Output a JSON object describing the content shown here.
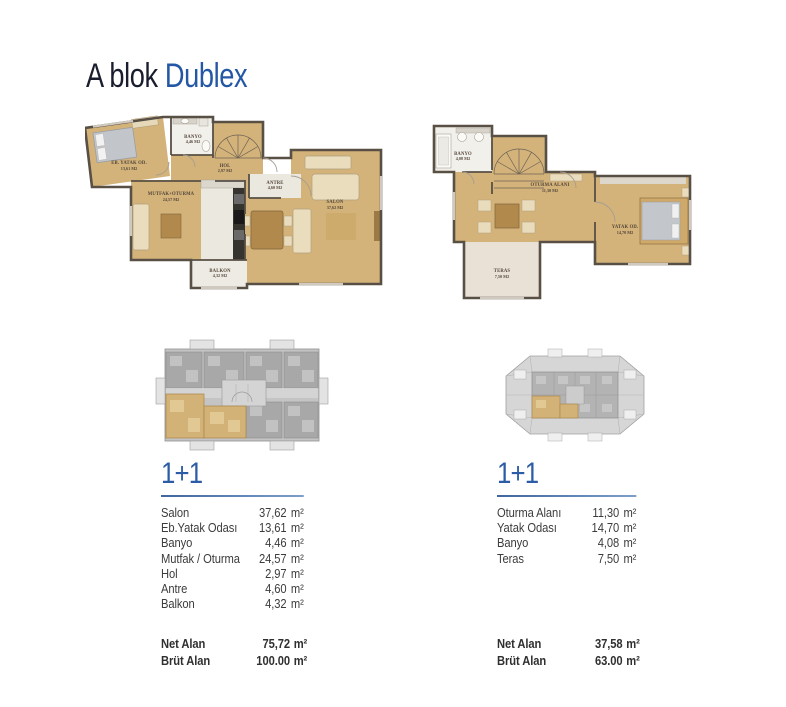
{
  "page": {
    "title_prefix": "A blok",
    "title_highlight": "Dublex"
  },
  "colors": {
    "accent_blue": "#2d5ca6",
    "title_dark": "#1a1d2e",
    "plan_room_tan": "#d3b37a",
    "plan_wall": "#584f45",
    "highlight_unit_tan": "#d2b277"
  },
  "left_unit": {
    "plan_type": "1+1",
    "plan": {
      "bedroom": {
        "name": "EB. YATAK OD.",
        "area": "13,61 M2"
      },
      "banyo": {
        "name": "BANYO",
        "area": "4,46 M2"
      },
      "hol": {
        "name": "HOL",
        "area": "2,97 M2"
      },
      "antre": {
        "name": "ANTRE",
        "area": "4,60 M2"
      },
      "salon": {
        "name": "SALON",
        "area": "37,62 M2"
      },
      "mutfak": {
        "name": "MUTFAK+OTURMA",
        "area": "24,57 M2"
      },
      "balkon": {
        "name": "BALKON",
        "area": "4,32 M2"
      }
    },
    "table": {
      "rows": [
        {
          "label": "Salon",
          "value": "37,62",
          "unit": "m²"
        },
        {
          "label": "Eb.Yatak Odası",
          "value": "13,61",
          "unit": "m²"
        },
        {
          "label": "Banyo",
          "value": "4,46",
          "unit": "m²"
        },
        {
          "label": "Mutfak / Oturma",
          "value": "24,57",
          "unit": "m²"
        },
        {
          "label": "Hol",
          "value": "2,97",
          "unit": "m²"
        },
        {
          "label": "Antre",
          "value": "4,60",
          "unit": "m²"
        },
        {
          "label": "Balkon",
          "value": "4,32",
          "unit": "m²"
        }
      ],
      "summary": [
        {
          "label": "Net Alan",
          "value": "75,72",
          "unit": "m²"
        },
        {
          "label": "Brüt Alan",
          "value": "100.00",
          "unit": "m²"
        }
      ]
    }
  },
  "right_unit": {
    "plan_type": "1+1",
    "plan": {
      "banyo": {
        "name": "BANYO",
        "area": "4,08 M2"
      },
      "oturma": {
        "name": "OTURMA ALANI",
        "area": "11,30 M2"
      },
      "yatak": {
        "name": "YATAK OD.",
        "area": "14,70 M2"
      },
      "teras": {
        "name": "TERAS",
        "area": "7,50 M2"
      }
    },
    "table": {
      "rows": [
        {
          "label": "Oturma Alanı",
          "value": "11,30",
          "unit": "m²"
        },
        {
          "label": "Yatak Odası",
          "value": "14,70",
          "unit": "m²"
        },
        {
          "label": "Banyo",
          "value": "4,08",
          "unit": "m²"
        },
        {
          "label": "Teras",
          "value": "7,50",
          "unit": "m²"
        }
      ],
      "summary": [
        {
          "label": "Net Alan",
          "value": "37,58",
          "unit": "m²"
        },
        {
          "label": "Brüt Alan",
          "value": "63.00",
          "unit": "m²"
        }
      ]
    }
  }
}
